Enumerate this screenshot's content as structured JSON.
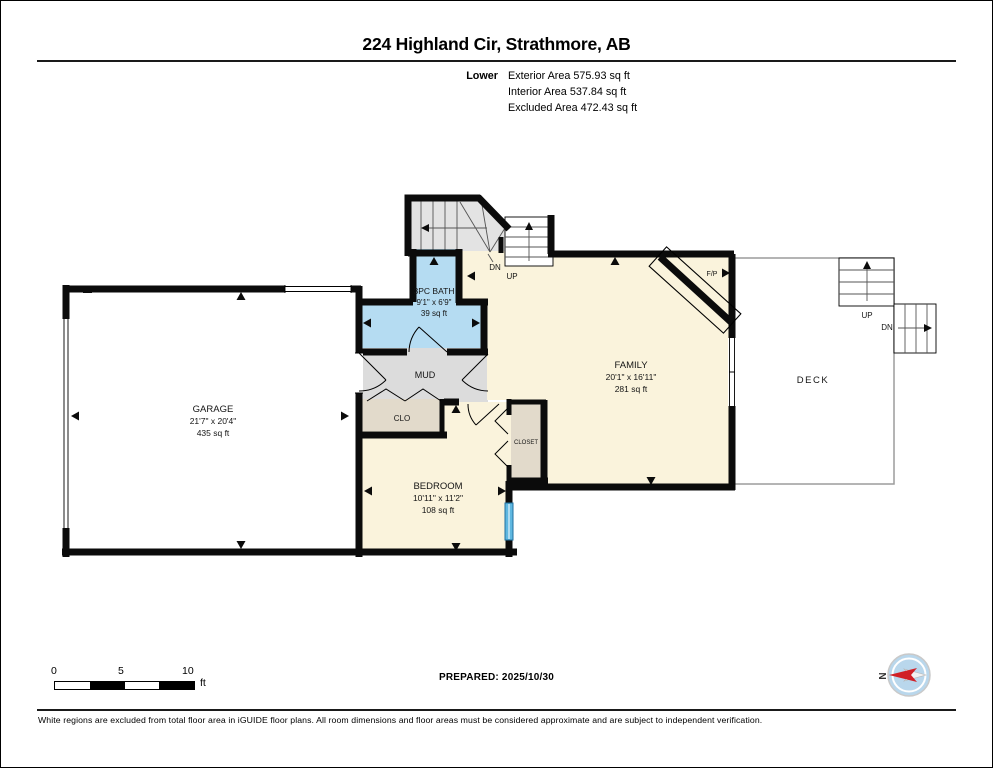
{
  "header": {
    "title": "224 Highland Cir, Strathmore, AB",
    "level_label": "Lower",
    "area_lines": [
      {
        "label": "Exterior Area",
        "value": "575.93 sq ft"
      },
      {
        "label": "Interior Area",
        "value": "537.84 sq ft"
      },
      {
        "label": "Excluded Area",
        "value": "472.43 sq ft"
      }
    ]
  },
  "plan": {
    "rooms": {
      "garage": {
        "name": "GARAGE",
        "dims": "21'7\" x 20'4\"",
        "area": "435 sq ft"
      },
      "bath": {
        "name": "3PC BATH",
        "dims": "9'1\" x 6'9\"",
        "area": "39 sq ft"
      },
      "mud": {
        "name": "MUD"
      },
      "clo": {
        "name": "CLO"
      },
      "family": {
        "name": "FAMILY",
        "dims": "20'1\" x 16'11\"",
        "area": "281 sq ft"
      },
      "closet": {
        "name": "CLOSET"
      },
      "bedroom": {
        "name": "BEDROOM",
        "dims": "10'11\" x 11'2\"",
        "area": "108 sq ft"
      },
      "deck": {
        "name": "DECK"
      }
    },
    "labels": {
      "dn_interior": "DN",
      "up_interior": "UP",
      "up_deck": "UP",
      "dn_deck": "DN",
      "fireplace": "F/P"
    }
  },
  "footer": {
    "scale_bar": {
      "ticks": [
        "0",
        "5",
        "10"
      ],
      "unit": "ft"
    },
    "prepared": "PREPARED: 2025/10/30",
    "compass_north": "N",
    "disclaimer": "White regions are excluded from total floor area in iGUIDE floor plans. All room dimensions and floor areas must be considered approximate and are subject to independent verification."
  },
  "colors": {
    "wall": "#0b0b0b",
    "room_cream": "#FAF3DC",
    "room_blue": "#B5DCF2",
    "room_gray": "#DCDCDC",
    "stairs_gray": "#E3E3E3",
    "room_tan": "#E2DACB",
    "window_blue": "#5FB7E0",
    "compass_face": "#B9D7EC",
    "compass_red": "#D12026"
  }
}
